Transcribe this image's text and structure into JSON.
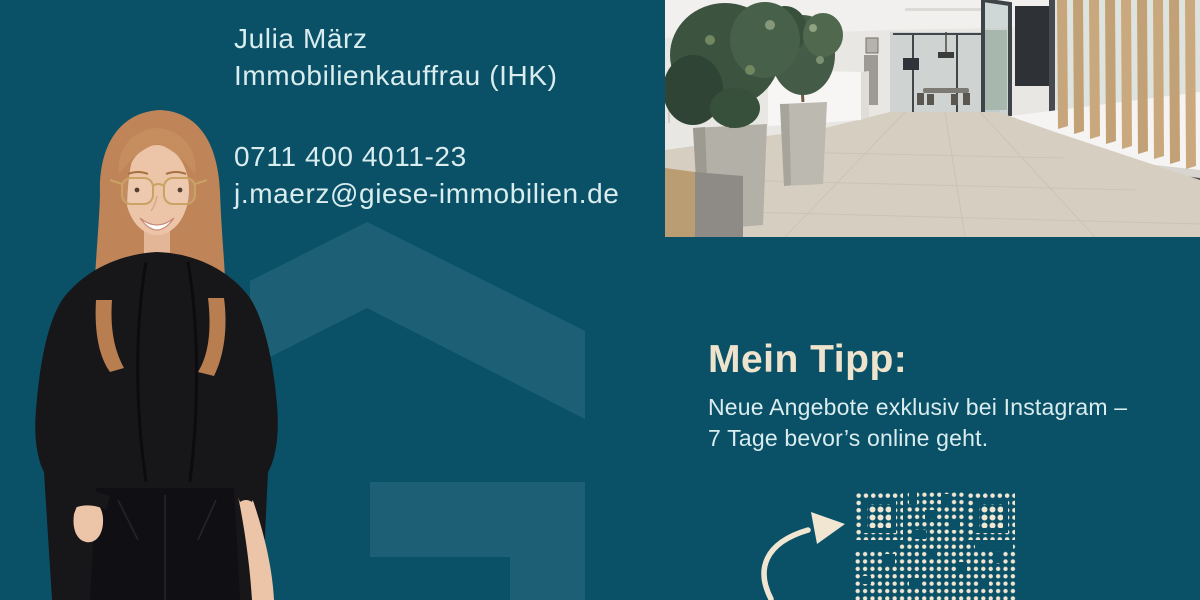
{
  "colors": {
    "bg": "#0a5168",
    "logo-tint": "#1d6076",
    "text-light": "#d9ecee",
    "cream": "#eee3cc",
    "qr-dot": "#f0e6d2"
  },
  "contact": {
    "name": "Julia März",
    "role": "Immobilienkauffrau (IHK)",
    "phone": "0711 400 4011-23",
    "email": "j.maerz@giese-immobilien.de"
  },
  "tip": {
    "heading": "Mein Tipp:",
    "line1": "Neue Angebote exklusiv bei Instagram –",
    "line2": "7 Tage bevor’s online geht."
  }
}
